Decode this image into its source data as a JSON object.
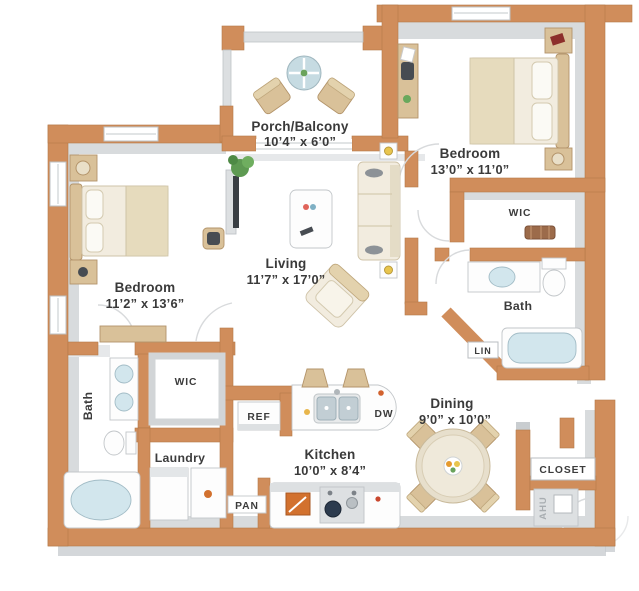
{
  "plan": {
    "title": "Two bedroom apartment floor plan",
    "rooms": {
      "porch": {
        "name": "Porch/Balcony",
        "dims": "10’4” x 6’0”"
      },
      "bedroom_right": {
        "name": "Bedroom",
        "dims": "13’0” x 11’0”"
      },
      "bedroom_left": {
        "name": "Bedroom",
        "dims": "11’2” x 13’6”"
      },
      "living": {
        "name": "Living",
        "dims": "11’7” x 17’0”"
      },
      "dining": {
        "name": "Dining",
        "dims": "9’0” x 10’0”"
      },
      "kitchen": {
        "name": "Kitchen",
        "dims": "10’0” x 8’4”"
      }
    },
    "labels": {
      "wic": "WIC",
      "bath": "Bath",
      "laundry": "Laundry",
      "lin": "LIN",
      "ref": "REF",
      "pan": "PAN",
      "dw": "DW",
      "closet": "CLOSET",
      "ahu": "AHU"
    },
    "colors": {
      "wall": "#d08d5b",
      "wall_edge": "#b47a49",
      "wall_face_gray": "#d8dbdd",
      "floor": "#ffffff",
      "furniture_tan": "#d9c199",
      "furniture_cream": "#f2ecdf",
      "fixture_water": "#d2e6ed",
      "text": "#3a3a3a",
      "ahu_text": "#a8adb1"
    }
  }
}
